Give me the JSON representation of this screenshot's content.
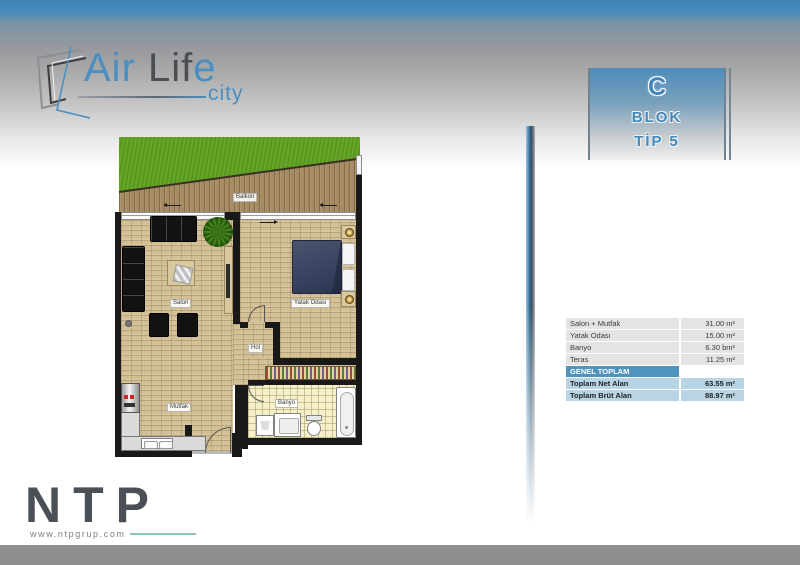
{
  "brand": {
    "air": "Air",
    "lif": " Lif",
    "e": "e",
    "city": "city"
  },
  "badge": {
    "letter": "C",
    "line1": "BLOK",
    "line2": "TİP 5"
  },
  "plan": {
    "labels": {
      "balkon": "Balkon",
      "salon": "Salon",
      "yatak": "Yatak Odası",
      "hol": "Hol",
      "mutfak": "Mutfak",
      "banyo": "Banyo"
    }
  },
  "table": {
    "rows": [
      {
        "label": "Salon + Mutfak",
        "value": "31.00 m²"
      },
      {
        "label": "Yatak Odası",
        "value": "15.00 m²"
      },
      {
        "label": "Banyo",
        "value": "6.30 bm²"
      },
      {
        "label": "Teras",
        "value": "11.25 m²"
      }
    ],
    "total_header": "GENEL TOPLAM",
    "totals": [
      {
        "label": "Toplam Net Alan",
        "value": "63.55 m²"
      },
      {
        "label": "Toplam Brüt Alan",
        "value": "88.97 m²"
      }
    ]
  },
  "footer": {
    "logo": "NTP",
    "website": "www.ntpgrup.com"
  },
  "colors": {
    "accent_blue": "#4a8fc0",
    "table_header_blue": "#4f94bd",
    "table_total_blue": "#b9d5e5",
    "footer_gray": "#8e8e8e",
    "grass_green": "#5ca01e",
    "wood_tan": "#d3c094",
    "bed_navy": "#3a4460"
  }
}
